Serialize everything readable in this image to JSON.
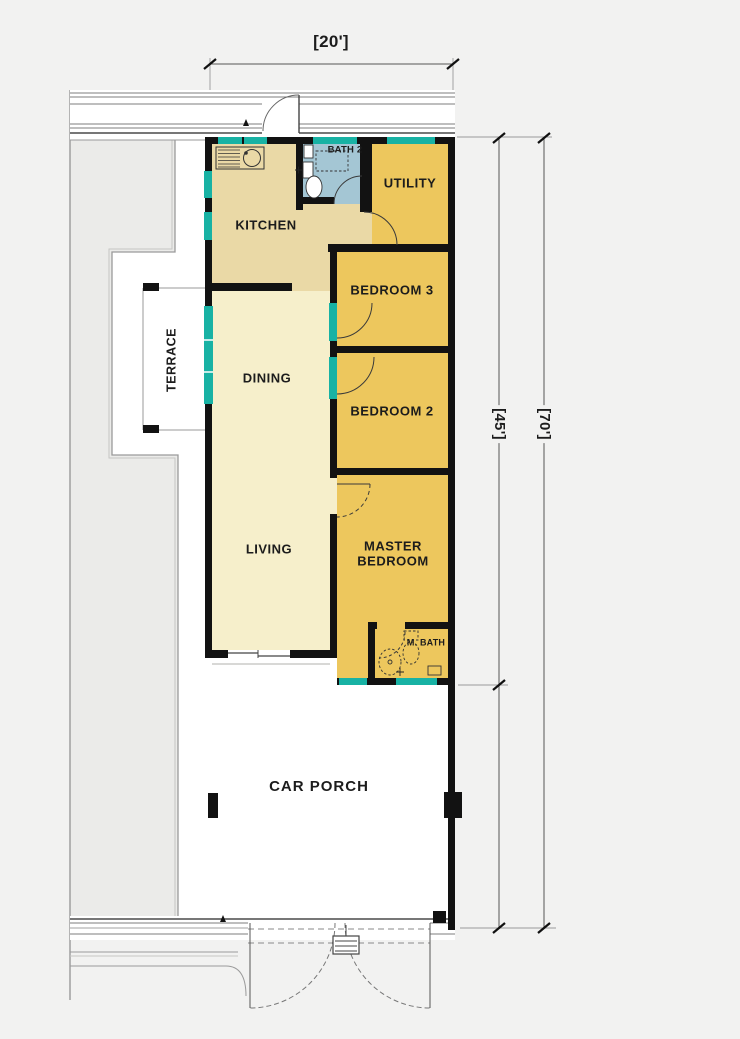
{
  "plan": {
    "title": "single-storey terrace house floor plan",
    "dimensions": {
      "top_width": "[20']",
      "right_building_depth": "[45']",
      "right_lot_depth": "[70']"
    },
    "rooms": {
      "kitchen": "KITCHEN",
      "bath2": "BATH 2",
      "utility": "UTILITY",
      "bedroom3": "BEDROOM 3",
      "bedroom2": "BEDROOM 2",
      "dining": "DINING",
      "living": "LIVING",
      "master": "MASTER BEDROOM",
      "mbath": "M. BATH",
      "terrace": "TERRACE",
      "carporch": "CAR PORCH"
    },
    "colors": {
      "background": "#f2f2f1",
      "lot_white": "#ffffff",
      "neighbor_gray": "#ebebe9",
      "room_yellow": "#edc75d",
      "kitchen_beige": "#ead9a6",
      "living_cream": "#f6efcb",
      "bath_blue": "#a4c6d4",
      "window_teal": "#18b2a4",
      "wall_black": "#121212",
      "line_gray": "#8c8c8c",
      "dim_gray": "#555555"
    }
  }
}
